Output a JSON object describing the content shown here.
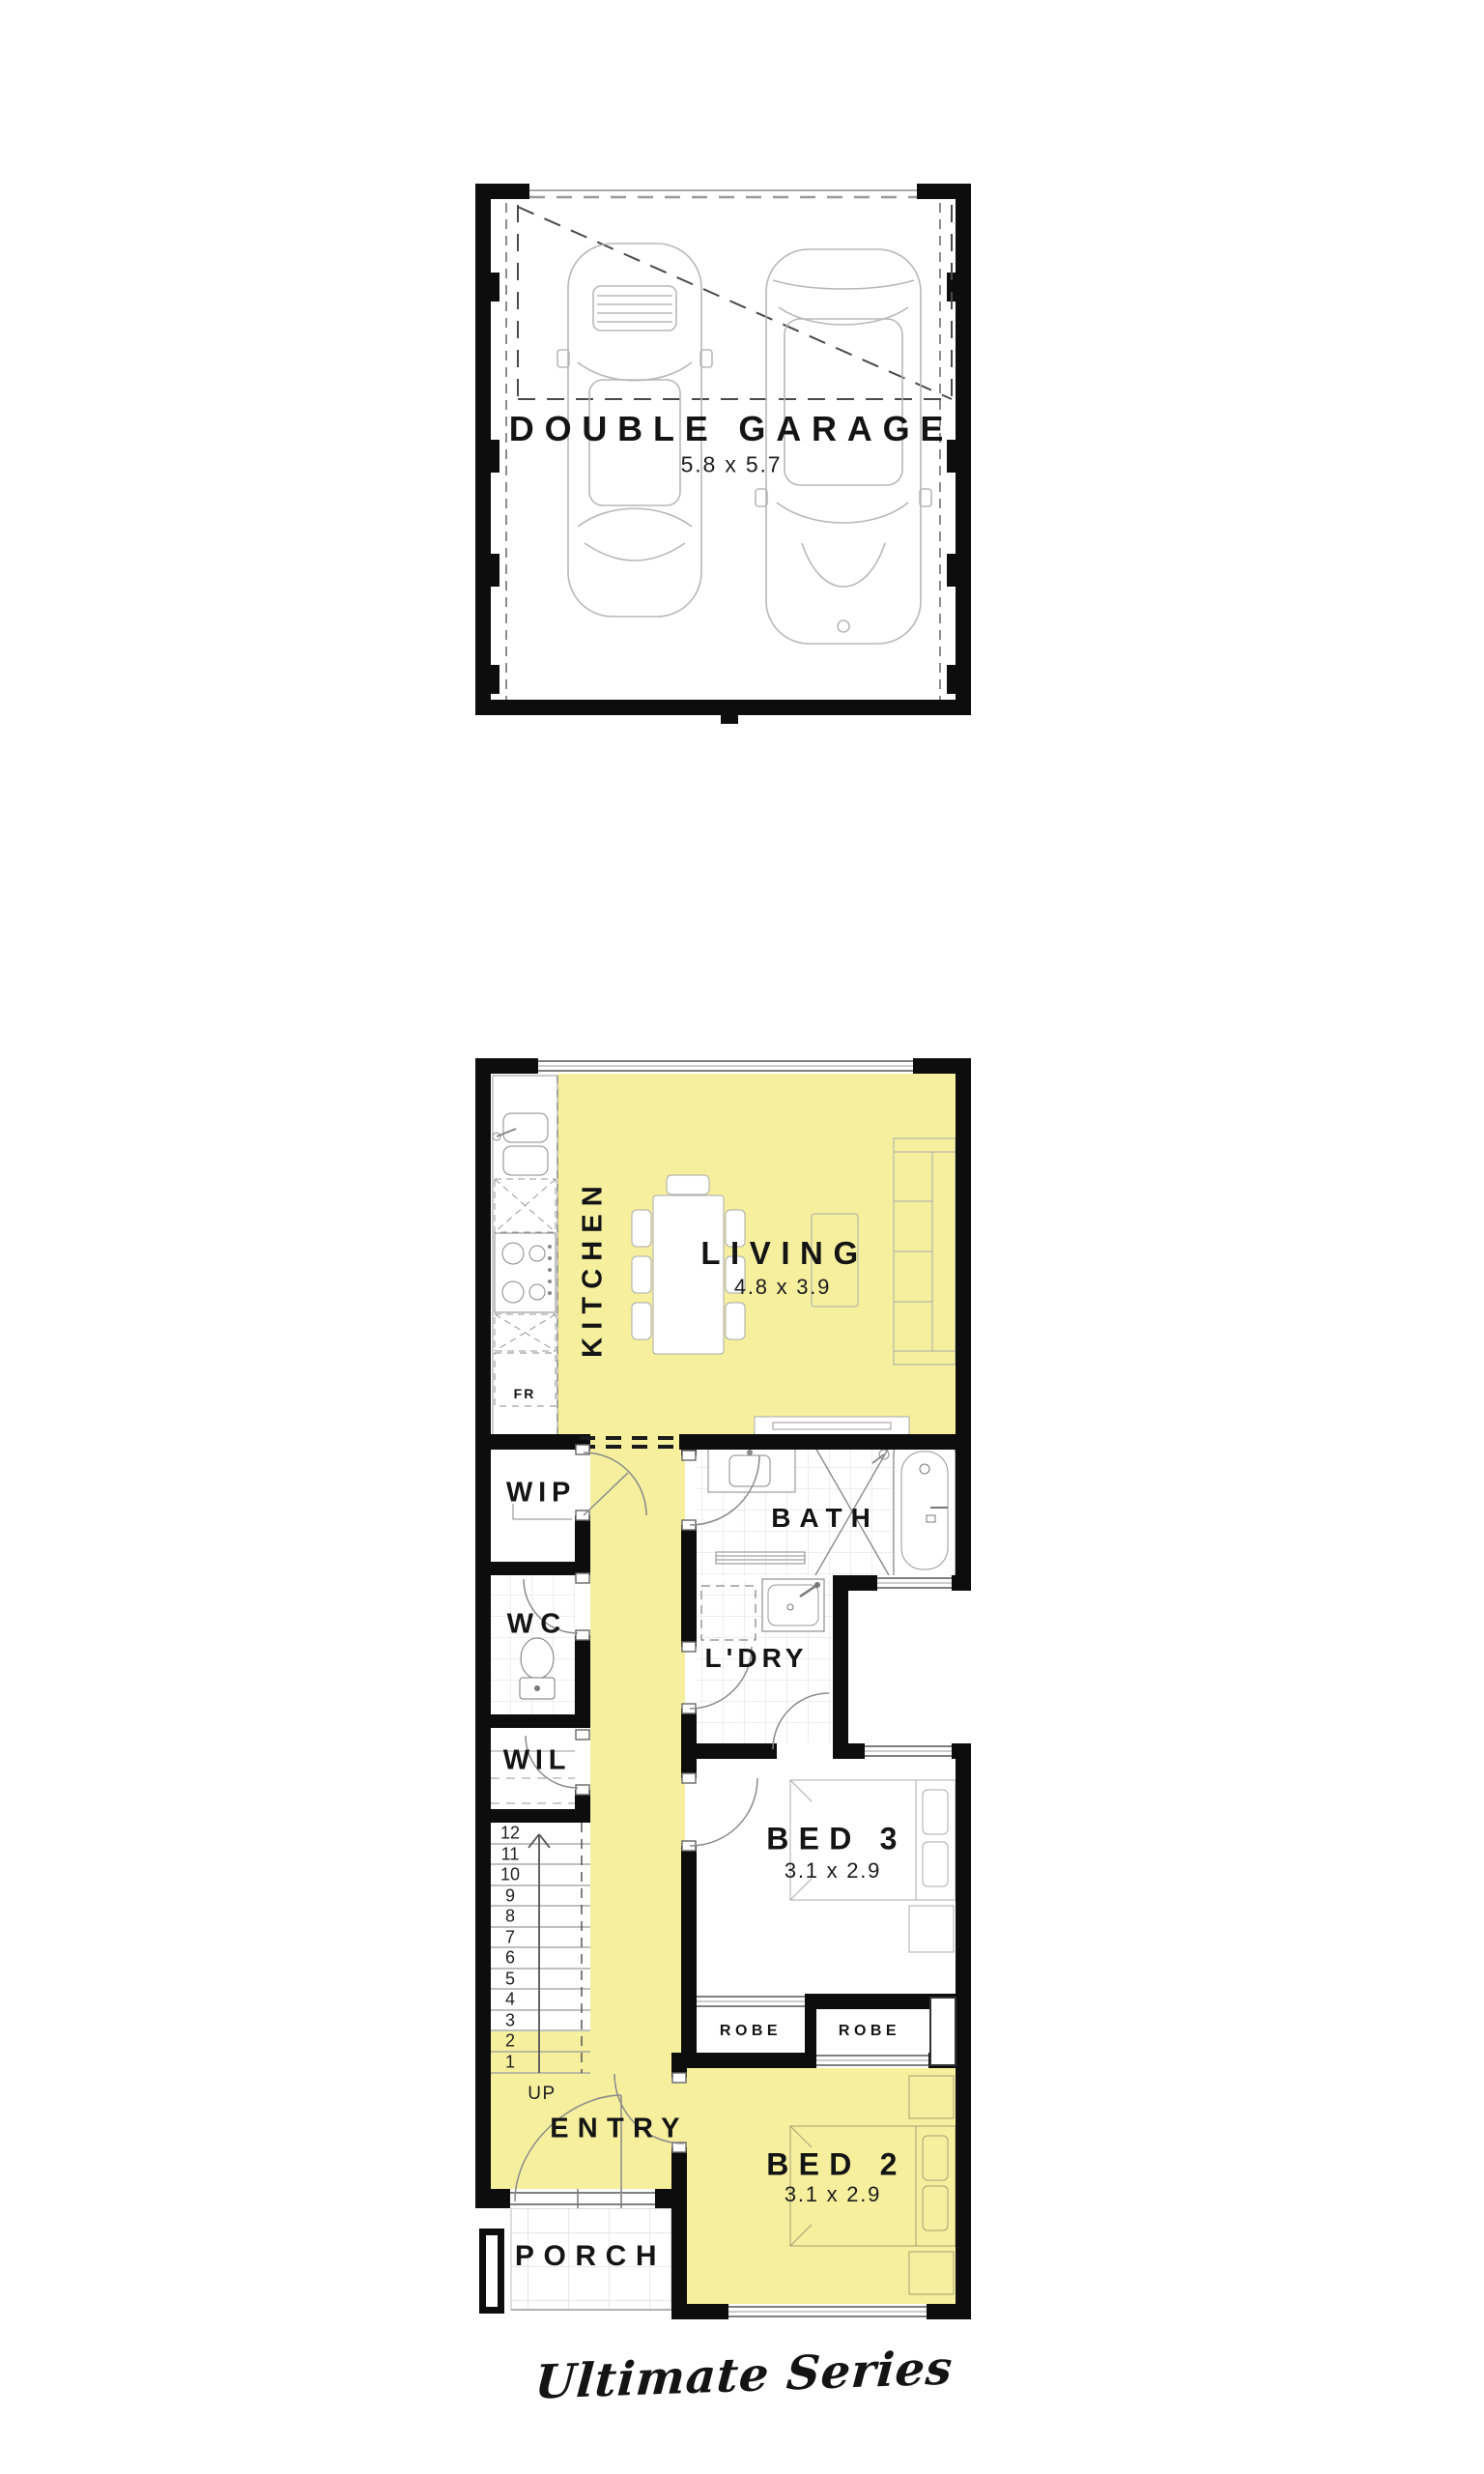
{
  "plan": {
    "brand": "Ultimate Series",
    "colors": {
      "highlight": "#f5ef9e",
      "wall": "#0d0d0d"
    },
    "upper": {
      "garage": {
        "name": "DOUBLE GARAGE",
        "dims": "5.8 x 5.7"
      }
    },
    "ground": {
      "living": {
        "name": "LIVING",
        "dims": "4.8 x 3.9"
      },
      "kitchen": {
        "name": "KITCHEN"
      },
      "fridge": {
        "label": "FR"
      },
      "wip": {
        "name": "WIP"
      },
      "wc": {
        "name": "WC"
      },
      "wil": {
        "name": "WIL"
      },
      "bath": {
        "name": "BATH"
      },
      "laundry": {
        "name": "L'DRY"
      },
      "bed3": {
        "name": "BED 3",
        "dims": "3.1 x 2.9"
      },
      "bed2": {
        "name": "BED 2",
        "dims": "3.1 x 2.9"
      },
      "robe_left": {
        "name": "ROBE"
      },
      "robe_right": {
        "name": "ROBE"
      },
      "entry": {
        "name": "ENTRY"
      },
      "porch": {
        "name": "PORCH"
      },
      "stairs": {
        "up": "UP",
        "numbers": [
          "12",
          "11",
          "10",
          "9",
          "8",
          "7",
          "6",
          "5",
          "4",
          "3",
          "2",
          "1"
        ]
      }
    }
  }
}
